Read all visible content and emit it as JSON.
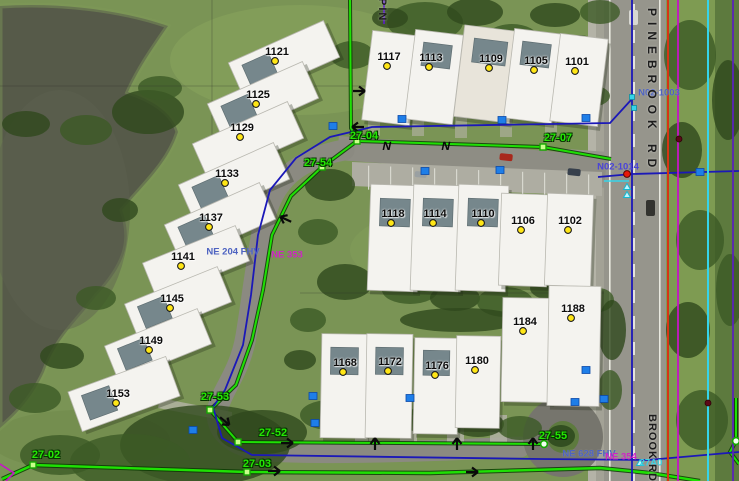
{
  "map": {
    "streets": {
      "pinebrook_top": "PINEBROOK RD",
      "pinebrook_bottom": "BROOK RD",
      "top_partial": "PIN"
    },
    "colors": {
      "green": "#1fe004",
      "navy": "#1b18b8",
      "red": "#d63415",
      "magenta": "#c615c6",
      "cyan": "#35d4ea",
      "purple": "#5a23b8",
      "grid": "rgba(40,40,40,0.35)",
      "marker_blue": "#1e7ee8",
      "point_yellow": "#ffe616"
    },
    "buildings": [
      {
        "label": "1121",
        "x": 277,
        "y": 52,
        "cx": 284,
        "cy": 60,
        "w": 104,
        "h": 40,
        "rot": -24,
        "panel": 1
      },
      {
        "label": "1125",
        "x": 258,
        "y": 95,
        "cx": 263,
        "cy": 101,
        "w": 104,
        "h": 40,
        "rot": -24,
        "panel": 1
      },
      {
        "label": "1129",
        "x": 242,
        "y": 128,
        "cx": 248,
        "cy": 141,
        "w": 104,
        "h": 40,
        "rot": -24,
        "panel": 0
      },
      {
        "label": "1133",
        "x": 227,
        "y": 174,
        "cx": 234,
        "cy": 182,
        "w": 104,
        "h": 40,
        "rot": -24,
        "panel": 1
      },
      {
        "label": "1137",
        "x": 211,
        "y": 218,
        "cx": 220,
        "cy": 222,
        "w": 104,
        "h": 40,
        "rot": -24,
        "panel": 1
      },
      {
        "label": "1141",
        "x": 183,
        "y": 257,
        "cx": 196,
        "cy": 262,
        "w": 100,
        "h": 38,
        "rot": -22,
        "panel": 0
      },
      {
        "label": "1145",
        "x": 172,
        "y": 299,
        "cx": 178,
        "cy": 303,
        "w": 100,
        "h": 38,
        "rot": -22,
        "panel": 1
      },
      {
        "label": "1149",
        "x": 151,
        "y": 341,
        "cx": 158,
        "cy": 345,
        "w": 100,
        "h": 38,
        "rot": -22,
        "panel": 1
      },
      {
        "label": "1153",
        "x": 118,
        "y": 394,
        "cx": 124,
        "cy": 394,
        "w": 104,
        "h": 42,
        "rot": -20,
        "panel": 1
      },
      {
        "label": "1117",
        "x": 389,
        "y": 57,
        "cx": 391,
        "cy": 78,
        "w": 48,
        "h": 90,
        "rot": 7,
        "panel": 0
      },
      {
        "label": "1113",
        "x": 431,
        "y": 58,
        "cx": 434,
        "cy": 77,
        "w": 48,
        "h": 90,
        "rot": 7,
        "panel": 1
      },
      {
        "label": "1109",
        "x": 491,
        "y": 59,
        "cx": 487,
        "cy": 74,
        "w": 56,
        "h": 92,
        "rot": 7,
        "panel": 1
      },
      {
        "label": "1105",
        "x": 536,
        "y": 61,
        "cx": 533,
        "cy": 76,
        "w": 48,
        "h": 90,
        "rot": 7,
        "panel": 1
      },
      {
        "label": "1101",
        "x": 577,
        "y": 62,
        "cx": 579,
        "cy": 80,
        "w": 48,
        "h": 88,
        "rot": 7,
        "panel": 0
      },
      {
        "label": "1118",
        "x": 393,
        "y": 214,
        "cx": 394,
        "cy": 238,
        "w": 50,
        "h": 106,
        "rot": 2,
        "panel": 1
      },
      {
        "label": "1114",
        "x": 435,
        "y": 214,
        "cx": 437,
        "cy": 238,
        "w": 50,
        "h": 106,
        "rot": 2,
        "panel": 1
      },
      {
        "label": "1110",
        "x": 483,
        "y": 214,
        "cx": 482,
        "cy": 238,
        "w": 50,
        "h": 106,
        "rot": 2,
        "panel": 1
      },
      {
        "label": "1106",
        "x": 523,
        "y": 221,
        "cx": 524,
        "cy": 240,
        "w": 48,
        "h": 92,
        "rot": 2,
        "panel": 0
      },
      {
        "label": "1102",
        "x": 570,
        "y": 221,
        "cx": 569,
        "cy": 240,
        "w": 46,
        "h": 92,
        "rot": 2,
        "panel": 0
      },
      {
        "label": "1168",
        "x": 345,
        "y": 363,
        "cx": 344,
        "cy": 386,
        "w": 46,
        "h": 104,
        "rot": 1,
        "panel": 1
      },
      {
        "label": "1172",
        "x": 390,
        "y": 362,
        "cx": 389,
        "cy": 386,
        "w": 46,
        "h": 104,
        "rot": 1,
        "panel": 1
      },
      {
        "label": "1176",
        "x": 437,
        "y": 366,
        "cx": 436,
        "cy": 386,
        "w": 44,
        "h": 96,
        "rot": 1,
        "panel": 1
      },
      {
        "label": "1180",
        "x": 477,
        "y": 361,
        "cx": 478,
        "cy": 382,
        "w": 44,
        "h": 92,
        "rot": 1,
        "panel": 0
      },
      {
        "label": "1184",
        "x": 525,
        "y": 322,
        "cx": 527,
        "cy": 350,
        "w": 50,
        "h": 104,
        "rot": 1,
        "panel": 0
      },
      {
        "label": "1188",
        "x": 573,
        "y": 309,
        "cx": 574,
        "cy": 346,
        "w": 52,
        "h": 120,
        "rot": 1,
        "panel": 0
      }
    ],
    "pipe_labels": [
      {
        "text": "27-04",
        "x": 364,
        "y": 136
      },
      {
        "text": "27-07",
        "x": 558,
        "y": 138
      },
      {
        "text": "27-54",
        "x": 318,
        "y": 163
      },
      {
        "text": "27-53",
        "x": 215,
        "y": 397
      },
      {
        "text": "27-52",
        "x": 273,
        "y": 433
      },
      {
        "text": "27-55",
        "x": 553,
        "y": 436
      },
      {
        "text": "27-02",
        "x": 46,
        "y": 455
      },
      {
        "text": "27-03",
        "x": 257,
        "y": 464
      }
    ],
    "id_labels": [
      {
        "text": "N02-1003",
        "style": "blue",
        "x": 659,
        "y": 93
      },
      {
        "text": "N02-1014",
        "style": "blueviolet",
        "x": 618,
        "y": 167
      },
      {
        "text": "NE 204 FHV",
        "style": "blue",
        "x": 233,
        "y": 252
      },
      {
        "text": "NE 353",
        "style": "magenta",
        "x": 287,
        "y": 255
      },
      {
        "text": "NE 628 FHV",
        "style": "blue",
        "x": 589,
        "y": 454
      },
      {
        "text": "NE 354",
        "style": "magenta",
        "x": 621,
        "y": 457
      },
      {
        "text": "27A0",
        "style": "cyan",
        "x": 651,
        "y": 463
      }
    ],
    "utility_lines": [
      {
        "name": "grid-horizontal-1",
        "c": "grid",
        "w": 0.8,
        "p": [
          [
            0,
            86
          ],
          [
            598,
            86
          ]
        ]
      },
      {
        "name": "grid-vertical-1",
        "c": "grid",
        "w": 0.8,
        "p": [
          [
            212,
            0
          ],
          [
            212,
            253
          ]
        ]
      },
      {
        "name": "grid-horizontal-2",
        "c": "grid",
        "w": 0.8,
        "p": [
          [
            300,
            293
          ],
          [
            604,
            293
          ]
        ]
      },
      {
        "name": "sewer-top-vertical",
        "c": "green",
        "w": 2,
        "halo": 1,
        "p": [
          [
            350,
            0
          ],
          [
            351,
            128
          ],
          [
            357,
            141
          ]
        ]
      },
      {
        "name": "sewer-top-horizontal",
        "c": "green",
        "w": 2,
        "halo": 1,
        "p": [
          [
            357,
            141
          ],
          [
            543,
            147
          ],
          [
            611,
            159
          ]
        ]
      },
      {
        "name": "sewer-west-loop",
        "c": "green",
        "w": 2,
        "halo": 1,
        "p": [
          [
            357,
            141
          ],
          [
            322,
            167
          ],
          [
            291,
            196
          ],
          [
            272,
            235
          ],
          [
            263,
            290
          ],
          [
            252,
            340
          ],
          [
            236,
            385
          ],
          [
            210,
            410
          ]
        ]
      },
      {
        "name": "sewer-27-53",
        "c": "green",
        "w": 2,
        "halo": 1,
        "p": [
          [
            210,
            410
          ],
          [
            238,
            442
          ]
        ]
      },
      {
        "name": "sewer-bottom-inner",
        "c": "green",
        "w": 2,
        "halo": 1,
        "p": [
          [
            238,
            442
          ],
          [
            544,
            444
          ]
        ]
      },
      {
        "name": "sewer-bottom-outer",
        "c": "green",
        "w": 2.4,
        "halo": 1,
        "p": [
          [
            2,
            479
          ],
          [
            33,
            465
          ],
          [
            247,
            472
          ],
          [
            430,
            473
          ],
          [
            600,
            468
          ],
          [
            650,
            473
          ],
          [
            700,
            481
          ]
        ]
      },
      {
        "name": "sewer-right-segment",
        "c": "green",
        "w": 2,
        "halo": 1,
        "p": [
          [
            736,
            398
          ],
          [
            736,
            441
          ],
          [
            730,
            452
          ],
          [
            739,
            464
          ]
        ]
      },
      {
        "name": "water-loop",
        "c": "navy",
        "w": 1.8,
        "p": [
          [
            631,
            100
          ],
          [
            610,
            123
          ],
          [
            372,
            127
          ],
          [
            330,
            137
          ],
          [
            296,
            158
          ],
          [
            270,
            190
          ],
          [
            258,
            235
          ],
          [
            251,
            295
          ],
          [
            243,
            345
          ],
          [
            225,
            390
          ],
          [
            213,
            407
          ],
          [
            222,
            438
          ],
          [
            252,
            455
          ],
          [
            540,
            459
          ],
          [
            648,
            460
          ],
          [
            739,
            452
          ]
        ]
      },
      {
        "name": "water-road-vertical",
        "c": "navy",
        "w": 1.8,
        "p": [
          [
            632,
            0
          ],
          [
            632,
            481
          ]
        ]
      },
      {
        "name": "water-crossing",
        "c": "navy",
        "w": 1.8,
        "p": [
          [
            598,
            177
          ],
          [
            632,
            174
          ],
          [
            739,
            171
          ]
        ]
      },
      {
        "name": "purple-road-line",
        "c": "purple",
        "w": 1.8,
        "p": [
          [
            733,
            0
          ],
          [
            733,
            481
          ]
        ]
      },
      {
        "name": "red-road-line",
        "c": "red",
        "w": 2,
        "p": [
          [
            668,
            0
          ],
          [
            668,
            481
          ]
        ]
      },
      {
        "name": "magenta-road-line",
        "c": "magenta",
        "w": 1.8,
        "p": [
          [
            678,
            0
          ],
          [
            678,
            481
          ]
        ]
      },
      {
        "name": "cyan-road-line",
        "c": "cyan",
        "w": 2,
        "p": [
          [
            708,
            0
          ],
          [
            708,
            481
          ]
        ]
      },
      {
        "name": "purple-top-stub",
        "c": "purple",
        "w": 1.8,
        "p": [
          [
            384,
            0
          ],
          [
            384,
            24
          ]
        ]
      },
      {
        "name": "magenta-corner-stub",
        "c": "magenta",
        "w": 1.6,
        "p": [
          [
            0,
            464
          ],
          [
            14,
            473
          ],
          [
            6,
            481
          ]
        ]
      },
      {
        "name": "cyan-crossing-stub",
        "c": "cyan",
        "w": 1.5,
        "p": [
          [
            604,
            181
          ],
          [
            629,
            181
          ]
        ]
      }
    ],
    "point_markers": [
      {
        "t": "sq-green",
        "x": 357,
        "y": 141
      },
      {
        "t": "sq-green",
        "x": 543,
        "y": 147
      },
      {
        "t": "sq-green",
        "x": 322,
        "y": 167
      },
      {
        "t": "sq-green",
        "x": 210,
        "y": 410
      },
      {
        "t": "sq-green",
        "x": 238,
        "y": 442
      },
      {
        "t": "sq-green",
        "x": 33,
        "y": 465
      },
      {
        "t": "sq-green",
        "x": 247,
        "y": 472
      },
      {
        "t": "circ-green",
        "x": 544,
        "y": 444
      },
      {
        "t": "circ-green",
        "x": 736,
        "y": 441
      },
      {
        "t": "sq-blue",
        "x": 333,
        "y": 126
      },
      {
        "t": "sq-blue",
        "x": 402,
        "y": 119
      },
      {
        "t": "sq-blue",
        "x": 502,
        "y": 120
      },
      {
        "t": "sq-blue",
        "x": 586,
        "y": 118
      },
      {
        "t": "sq-blue",
        "x": 425,
        "y": 171
      },
      {
        "t": "sq-blue",
        "x": 500,
        "y": 170
      },
      {
        "t": "sq-blue",
        "x": 700,
        "y": 172
      },
      {
        "t": "sq-blue",
        "x": 313,
        "y": 396
      },
      {
        "t": "sq-blue",
        "x": 410,
        "y": 398
      },
      {
        "t": "sq-blue",
        "x": 575,
        "y": 402
      },
      {
        "t": "sq-blue",
        "x": 604,
        "y": 399
      },
      {
        "t": "sq-blue",
        "x": 586,
        "y": 370
      },
      {
        "t": "sq-blue",
        "x": 193,
        "y": 430
      },
      {
        "t": "sq-blue",
        "x": 315,
        "y": 423
      },
      {
        "t": "sq-cyan",
        "x": 632,
        "y": 97
      },
      {
        "t": "sq-cyan",
        "x": 634,
        "y": 108
      },
      {
        "t": "dot-red",
        "x": 627,
        "y": 174
      },
      {
        "t": "dot-darkred",
        "x": 679,
        "y": 139
      },
      {
        "t": "dot-darkred",
        "x": 708,
        "y": 403
      },
      {
        "t": "tri-cyan",
        "x": 627,
        "y": 187
      },
      {
        "t": "tri-cyan",
        "x": 627,
        "y": 195
      },
      {
        "t": "tri-cyan",
        "x": 640,
        "y": 463
      },
      {
        "t": "arrow",
        "x": 362,
        "y": 91,
        "r": 0
      },
      {
        "t": "arrow",
        "x": 355,
        "y": 127,
        "r": 180
      },
      {
        "t": "arrow",
        "x": 283,
        "y": 218,
        "r": 205
      },
      {
        "t": "arrow",
        "x": 227,
        "y": 423,
        "r": 40
      },
      {
        "t": "arrow",
        "x": 290,
        "y": 443,
        "r": 0
      },
      {
        "t": "arrow",
        "x": 277,
        "y": 471,
        "r": 0
      },
      {
        "t": "arrow",
        "x": 475,
        "y": 472,
        "r": 0
      },
      {
        "t": "arrow",
        "x": 375,
        "y": 441,
        "r": 270
      },
      {
        "t": "arrow",
        "x": 457,
        "y": 441,
        "r": 270
      },
      {
        "t": "arrow",
        "x": 533,
        "y": 441,
        "r": 270
      },
      {
        "t": "flow-symbol",
        "x": 418,
        "y": 146
      },
      {
        "t": "flow-symbol",
        "x": 477,
        "y": 146
      }
    ]
  }
}
